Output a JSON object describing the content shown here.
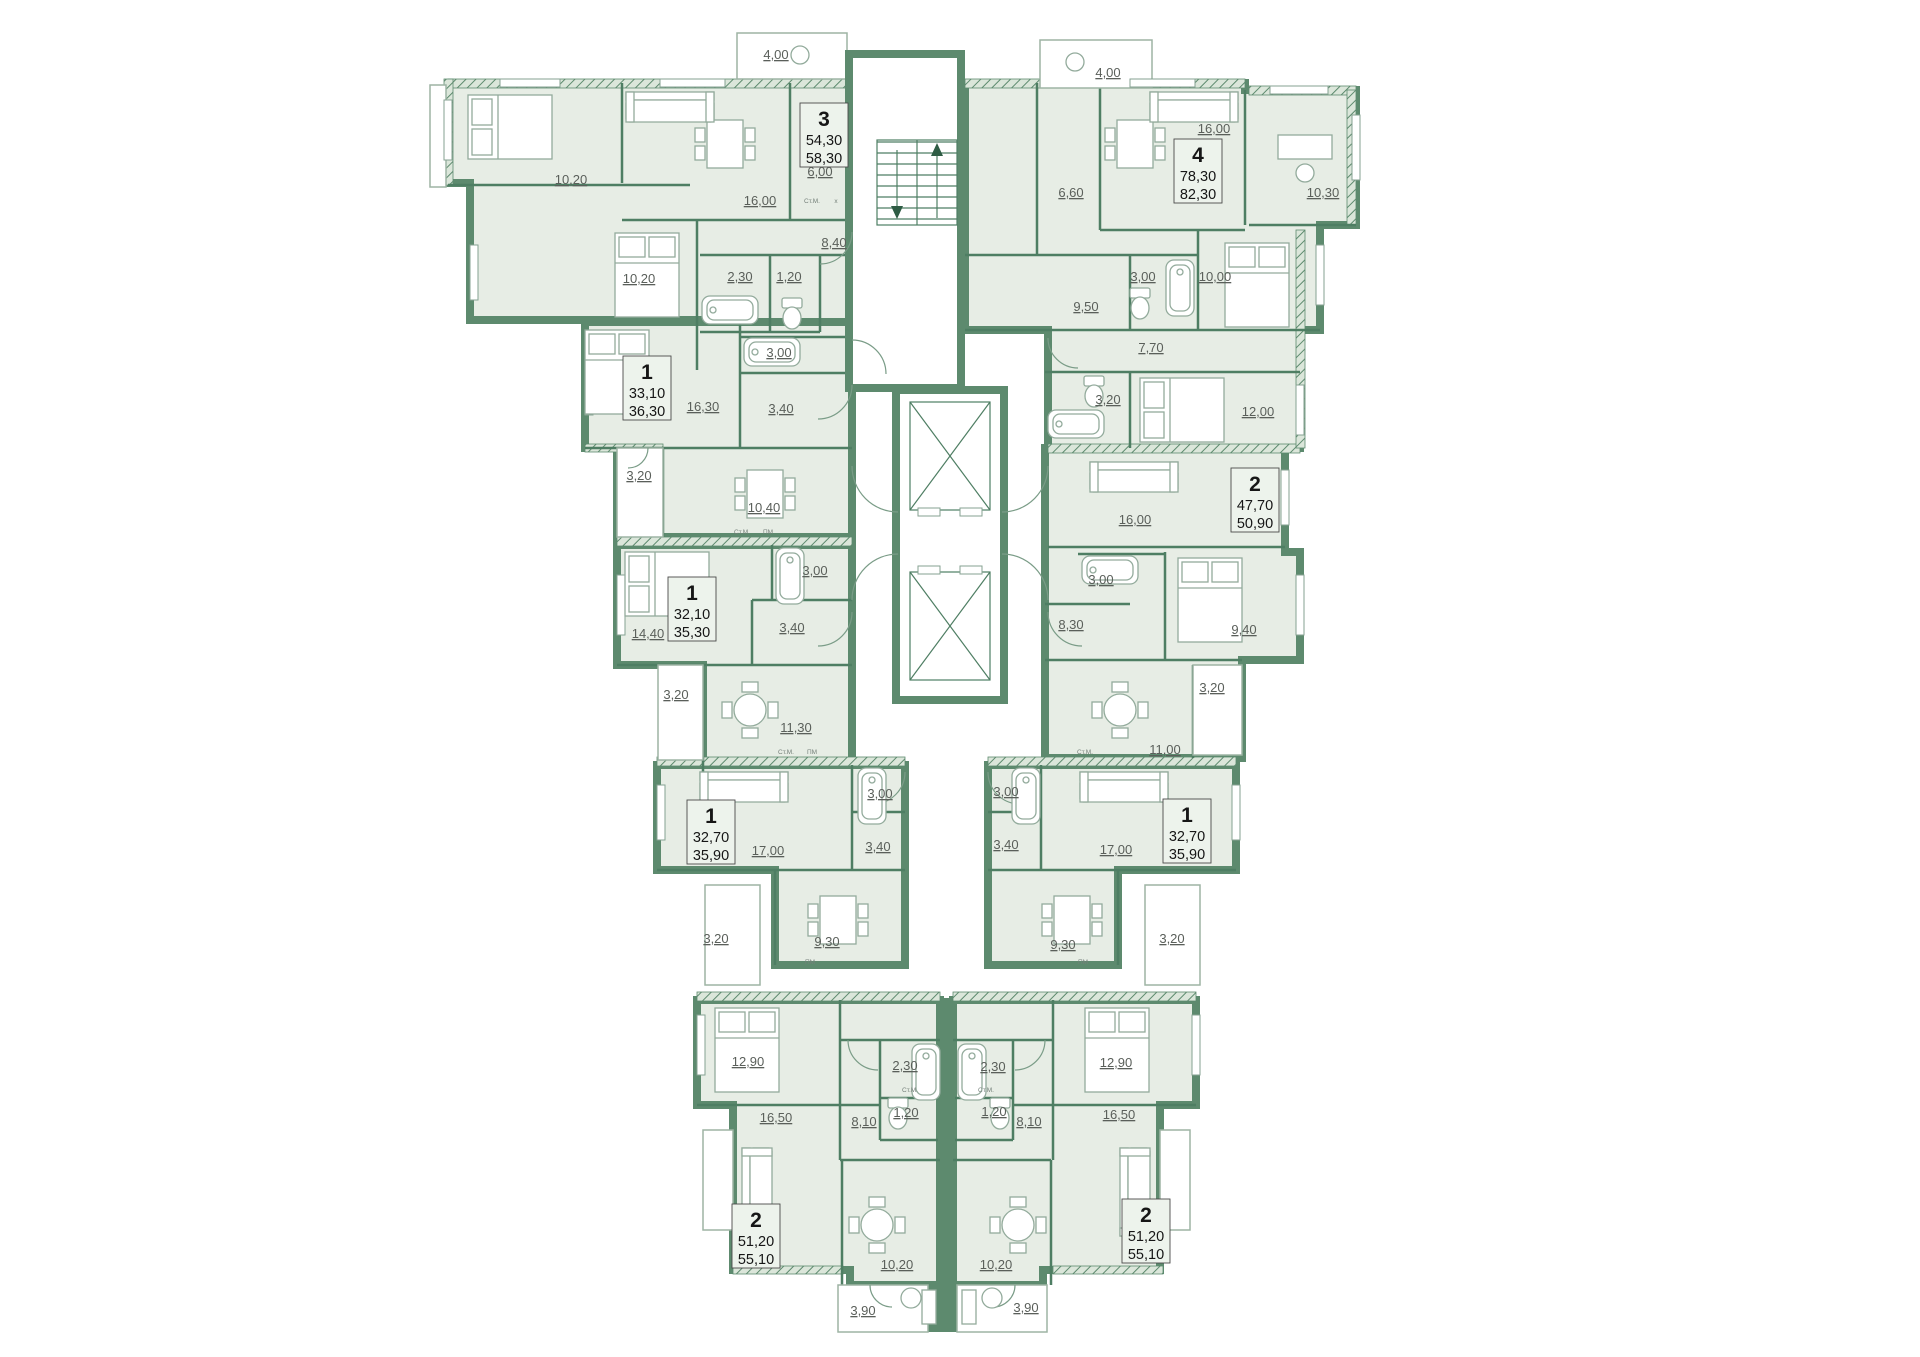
{
  "plan": {
    "type": "residential-floor-plan",
    "colors": {
      "wall": "#5d8a6e",
      "partition": "#4e7e63",
      "room_fill": "#e7ede5",
      "dim_text": "#5a5f5a",
      "apt_text": "#161616",
      "background": "#ffffff"
    },
    "apartments": [
      {
        "id": "apt-3-top-left",
        "rooms": "3",
        "area_living": "54,30",
        "area_total": "58,30",
        "x": 824,
        "y": 135
      },
      {
        "id": "apt-4-top-right",
        "rooms": "4",
        "area_living": "78,30",
        "area_total": "82,30",
        "x": 1198,
        "y": 171
      },
      {
        "id": "apt-1-upper-left",
        "rooms": "1",
        "area_living": "33,10",
        "area_total": "36,30",
        "x": 647,
        "y": 388
      },
      {
        "id": "apt-2-mid-right",
        "rooms": "2",
        "area_living": "47,70",
        "area_total": "50,90",
        "x": 1255,
        "y": 500
      },
      {
        "id": "apt-1-mid-left",
        "rooms": "1",
        "area_living": "32,10",
        "area_total": "35,30",
        "x": 692,
        "y": 609
      },
      {
        "id": "apt-1-lower-left",
        "rooms": "1",
        "area_living": "32,70",
        "area_total": "35,90",
        "x": 711,
        "y": 832
      },
      {
        "id": "apt-1-lower-right",
        "rooms": "1",
        "area_living": "32,70",
        "area_total": "35,90",
        "x": 1187,
        "y": 831
      },
      {
        "id": "apt-2-bottom-left",
        "rooms": "2",
        "area_living": "51,20",
        "area_total": "55,10",
        "x": 756,
        "y": 1236
      },
      {
        "id": "apt-2-bottom-right",
        "rooms": "2",
        "area_living": "51,20",
        "area_total": "55,10",
        "x": 1146,
        "y": 1231
      }
    ],
    "dim_labels": [
      {
        "t": "4,00",
        "x": 776,
        "y": 55
      },
      {
        "t": "10,20",
        "x": 571,
        "y": 180
      },
      {
        "t": "16,00",
        "x": 760,
        "y": 201
      },
      {
        "t": "6,00",
        "x": 820,
        "y": 172
      },
      {
        "t": "8,40",
        "x": 834,
        "y": 243
      },
      {
        "t": "10,20",
        "x": 639,
        "y": 279
      },
      {
        "t": "2,30",
        "x": 740,
        "y": 277
      },
      {
        "t": "1,20",
        "x": 789,
        "y": 277
      },
      {
        "t": "3,00",
        "x": 779,
        "y": 353
      },
      {
        "t": "16,30",
        "x": 703,
        "y": 407
      },
      {
        "t": "3,40",
        "x": 781,
        "y": 409
      },
      {
        "t": "3,20",
        "x": 639,
        "y": 476
      },
      {
        "t": "10,40",
        "x": 764,
        "y": 508
      },
      {
        "t": "14,40",
        "x": 648,
        "y": 634
      },
      {
        "t": "3,00",
        "x": 815,
        "y": 571
      },
      {
        "t": "3,40",
        "x": 792,
        "y": 628
      },
      {
        "t": "3,20",
        "x": 676,
        "y": 695
      },
      {
        "t": "11,30",
        "x": 796,
        "y": 728
      },
      {
        "t": "17,00",
        "x": 768,
        "y": 851
      },
      {
        "t": "3,00",
        "x": 880,
        "y": 794
      },
      {
        "t": "3,40",
        "x": 878,
        "y": 847
      },
      {
        "t": "3,20",
        "x": 716,
        "y": 939
      },
      {
        "t": "9,30",
        "x": 827,
        "y": 942
      },
      {
        "t": "12,90",
        "x": 748,
        "y": 1062
      },
      {
        "t": "16,50",
        "x": 776,
        "y": 1118
      },
      {
        "t": "8,10",
        "x": 864,
        "y": 1122
      },
      {
        "t": "2,30",
        "x": 905,
        "y": 1066
      },
      {
        "t": "1,20",
        "x": 906,
        "y": 1113
      },
      {
        "t": "10,20",
        "x": 897,
        "y": 1265
      },
      {
        "t": "3,90",
        "x": 863,
        "y": 1311
      },
      {
        "t": "4,00",
        "x": 1108,
        "y": 73
      },
      {
        "t": "16,00",
        "x": 1214,
        "y": 129
      },
      {
        "t": "6,60",
        "x": 1071,
        "y": 193
      },
      {
        "t": "9,50",
        "x": 1086,
        "y": 307
      },
      {
        "t": "3,00",
        "x": 1143,
        "y": 277
      },
      {
        "t": "10,00",
        "x": 1215,
        "y": 277
      },
      {
        "t": "7,70",
        "x": 1151,
        "y": 348
      },
      {
        "t": "10,30",
        "x": 1323,
        "y": 193
      },
      {
        "t": "3,20",
        "x": 1108,
        "y": 400
      },
      {
        "t": "12,00",
        "x": 1258,
        "y": 412
      },
      {
        "t": "16,00",
        "x": 1135,
        "y": 520
      },
      {
        "t": "3,00",
        "x": 1101,
        "y": 580
      },
      {
        "t": "8,30",
        "x": 1071,
        "y": 625
      },
      {
        "t": "9,40",
        "x": 1244,
        "y": 630
      },
      {
        "t": "3,20",
        "x": 1212,
        "y": 688
      },
      {
        "t": "11,00",
        "x": 1165,
        "y": 750
      },
      {
        "t": "3,00",
        "x": 1006,
        "y": 792
      },
      {
        "t": "3,40",
        "x": 1006,
        "y": 845
      },
      {
        "t": "17,00",
        "x": 1116,
        "y": 850
      },
      {
        "t": "3,20",
        "x": 1172,
        "y": 939
      },
      {
        "t": "9,30",
        "x": 1063,
        "y": 945
      },
      {
        "t": "12,90",
        "x": 1116,
        "y": 1063
      },
      {
        "t": "16,50",
        "x": 1119,
        "y": 1115
      },
      {
        "t": "8,10",
        "x": 1029,
        "y": 1122
      },
      {
        "t": "2,30",
        "x": 993,
        "y": 1067
      },
      {
        "t": "1,20",
        "x": 994,
        "y": 1112
      },
      {
        "t": "10,20",
        "x": 996,
        "y": 1265
      },
      {
        "t": "3,90",
        "x": 1026,
        "y": 1308
      }
    ],
    "appliance_labels": [
      {
        "t": "Ст.М.",
        "x": 812,
        "y": 201
      },
      {
        "t": "x",
        "x": 836,
        "y": 201
      },
      {
        "t": "Ст.М.",
        "x": 742,
        "y": 532
      },
      {
        "t": "ПМ",
        "x": 768,
        "y": 532
      },
      {
        "t": "Ст.М.",
        "x": 786,
        "y": 752
      },
      {
        "t": "ПМ",
        "x": 812,
        "y": 752
      },
      {
        "t": "Ст.М.",
        "x": 1085,
        "y": 752
      },
      {
        "t": "ПМ",
        "x": 810,
        "y": 962
      },
      {
        "t": "ПМ",
        "x": 1083,
        "y": 962
      },
      {
        "t": "Ст.М.",
        "x": 910,
        "y": 1090
      },
      {
        "t": "Ст.М.",
        "x": 986,
        "y": 1090
      }
    ]
  }
}
